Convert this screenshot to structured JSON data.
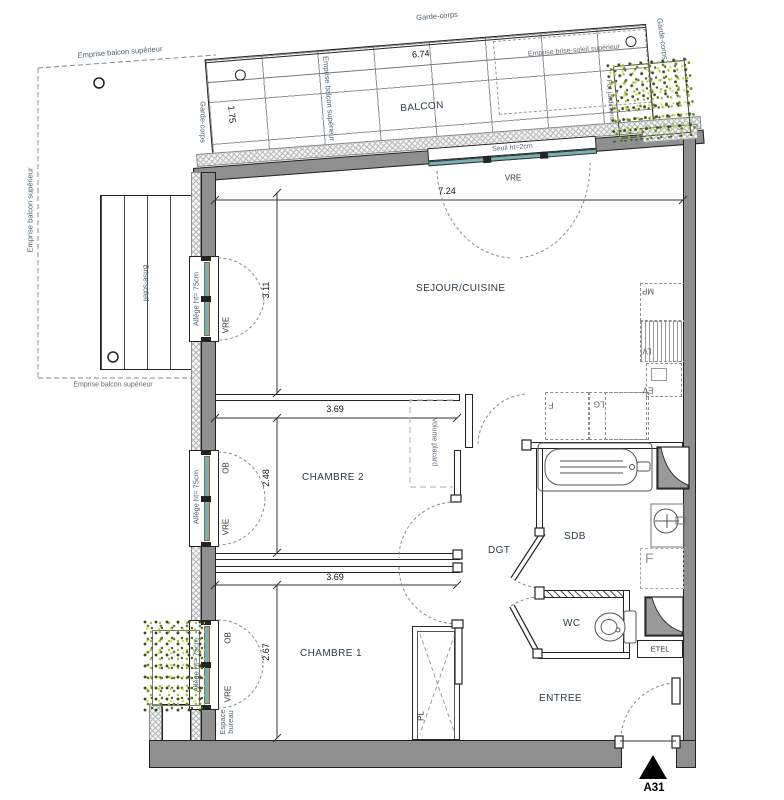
{
  "balcony": {
    "name": "BALCON",
    "width_dim": "6.74",
    "depth_dim": "1.75",
    "garde_corps": "Garde-corps",
    "emprise_balcon": "Emprise balcon supérieur",
    "emprise_brise_soleil": "Emprise brise-soleil supérieur",
    "pot_jardiniere": "Pot jardinière",
    "seuil": "Seuil ht=2cm",
    "door_type": "VRE"
  },
  "left_side": {
    "emprise_top": "Emprise balcon supérieur",
    "emprise_left": "Emprise balcon supérieur",
    "emprise_bottom": "Emprise balcon supérieur",
    "brise_soleil": "Brise-soleil",
    "espace_bureau": "Espace bureau"
  },
  "rooms": {
    "sejour_cuisine": "SEJOUR/CUISINE",
    "chambre2": "CHAMBRE 2",
    "chambre1": "CHAMBRE 1",
    "degagement": "DGT",
    "salle_de_bain": "SDB",
    "wc": "WC",
    "entree": "ENTREE",
    "etel": "ETEL"
  },
  "dimensions": {
    "sejour_width": "7.24",
    "sejour_depth": "3.11",
    "chambre2_width": "3.69",
    "chambre2_depth": "2.48",
    "chambre1_width": "3.69",
    "chambre1_depth": "2.67"
  },
  "windows": {
    "allege": "Allège ht= 75cm",
    "vre": "VRE",
    "ob": "OB"
  },
  "kitchen": {
    "mp": "MP",
    "lv": "LV",
    "ev": "EV",
    "fridge": "F",
    "lg": "LG",
    "cooktop": "CUI"
  },
  "annotations": {
    "volume_placard": "Volume placard",
    "placard": "PL",
    "fridge_sdb": "F"
  },
  "marker": {
    "label": "A31"
  }
}
